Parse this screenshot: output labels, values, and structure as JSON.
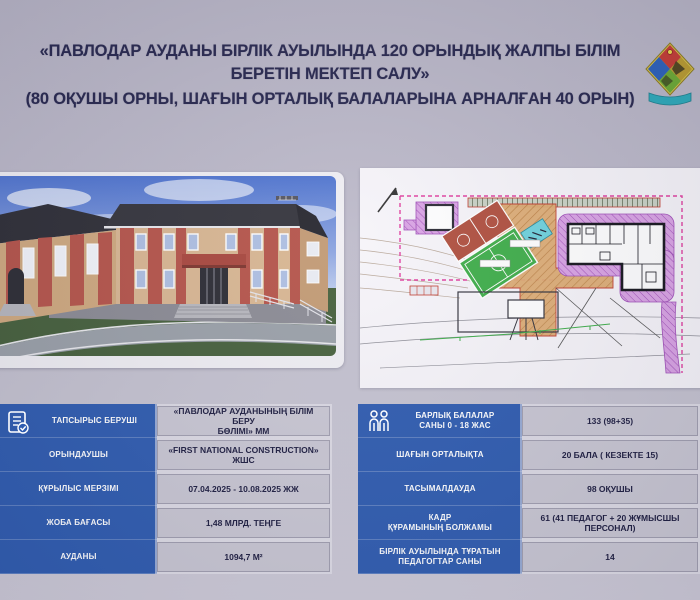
{
  "header": {
    "title_line1": "«ПАВЛОДАР АУДАНЫ БІРЛІК АУЫЛЫНДА 120 ОРЫНДЫҚ ЖАЛПЫ БІЛІМ",
    "title_line2": "БЕРЕТІН МЕКТЕП САЛУ»",
    "title_line3": "(80 ОҚУШЫ ОРНЫ, ШАҒЫН ОРТАЛЫҚ БАЛАЛАРЫНА АРНАЛҒАН 40 ОРЫН)"
  },
  "emblem": {
    "name": "pavlodar-district-crest",
    "colors": {
      "red": "#c23a34",
      "blue": "#2b5fb8",
      "olive": "#b89a2e",
      "green": "#6aa832",
      "ribbon": "#2ba8b8"
    }
  },
  "images": {
    "left": "school-building-3d-render",
    "right": "construction-site-master-plan"
  },
  "left_info_table": {
    "icon": "document-check-icon",
    "rows": [
      {
        "label": "ТАПСЫРЫС БЕРУШІ",
        "value": "«ПАВЛОДАР АУДАНЫНЫҢ БІЛІМ БЕРУ\nБӨЛІМІ» ММ"
      },
      {
        "label": "ОРЫНДАУШЫ",
        "value": "«FIRST NATIONAL CONSTRUCTION» ЖШС"
      },
      {
        "label": "ҚҰРЫЛЫС МЕРЗІМІ",
        "value": "07.04.2025 - 10.08.2025 ЖЖ"
      },
      {
        "label": "ЖОБА БАҒАСЫ",
        "value": "1,48 МЛРД. ТЕҢГЕ"
      },
      {
        "label": "АУДАНЫ",
        "value": "1094,7 М²"
      }
    ]
  },
  "right_info_table": {
    "icon": "children-icon",
    "rows": [
      {
        "label": "БАРЛЫҚ БАЛАЛАР\nСАНЫ 0 - 18 ЖАС",
        "value": "133 (98+35)"
      },
      {
        "label": "ШАҒЫН ОРТАЛЫҚТА",
        "value": "20 БАЛА ( КЕЗЕКТЕ 15)"
      },
      {
        "label": "ТАСЫМАЛДАУДА",
        "value": "98 ОҚУШЫ"
      },
      {
        "label": "КАДР\nҚҰРАМЫНЫҢ БОЛЖАМЫ",
        "value": "61 (41 ПЕДАГОГ + 20 ЖҰМЫСШЫ ПЕРСОНАЛ)"
      },
      {
        "label": "БІРЛІК АУЫЛЫНДА ТҰРАТЫН\nПЕДАГОГТАР САНЫ",
        "value": "14"
      }
    ]
  },
  "colors": {
    "accent_blue": "#2f5cb0",
    "value_cell_bg": "#c9c7d3",
    "title_text": "#26264d",
    "board_bg": "#bcb9c9"
  }
}
